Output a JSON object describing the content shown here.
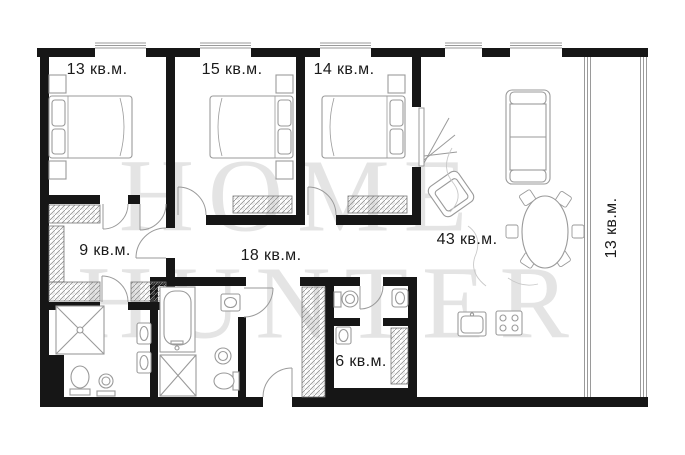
{
  "floorplan": {
    "watermark": {
      "line1": "HOME",
      "line2": "HUNTER"
    },
    "rooms": [
      {
        "id": "bedroom-13",
        "label": "13 кв.м."
      },
      {
        "id": "bedroom-15",
        "label": "15 кв.м."
      },
      {
        "id": "bedroom-14",
        "label": "14 кв.м."
      },
      {
        "id": "closet-9",
        "label": "9 кв.м."
      },
      {
        "id": "hallway-18",
        "label": "18 кв.м."
      },
      {
        "id": "living-43",
        "label": "43 кв.м."
      },
      {
        "id": "laundry-6",
        "label": "6 кв.м."
      },
      {
        "id": "balcony-13",
        "label": "13 кв.м."
      }
    ],
    "colors": {
      "wall": "#161616",
      "furniture_outline": "#9a9a9a",
      "label": "#1b1b1b",
      "watermark": "#e4e4e4"
    }
  }
}
